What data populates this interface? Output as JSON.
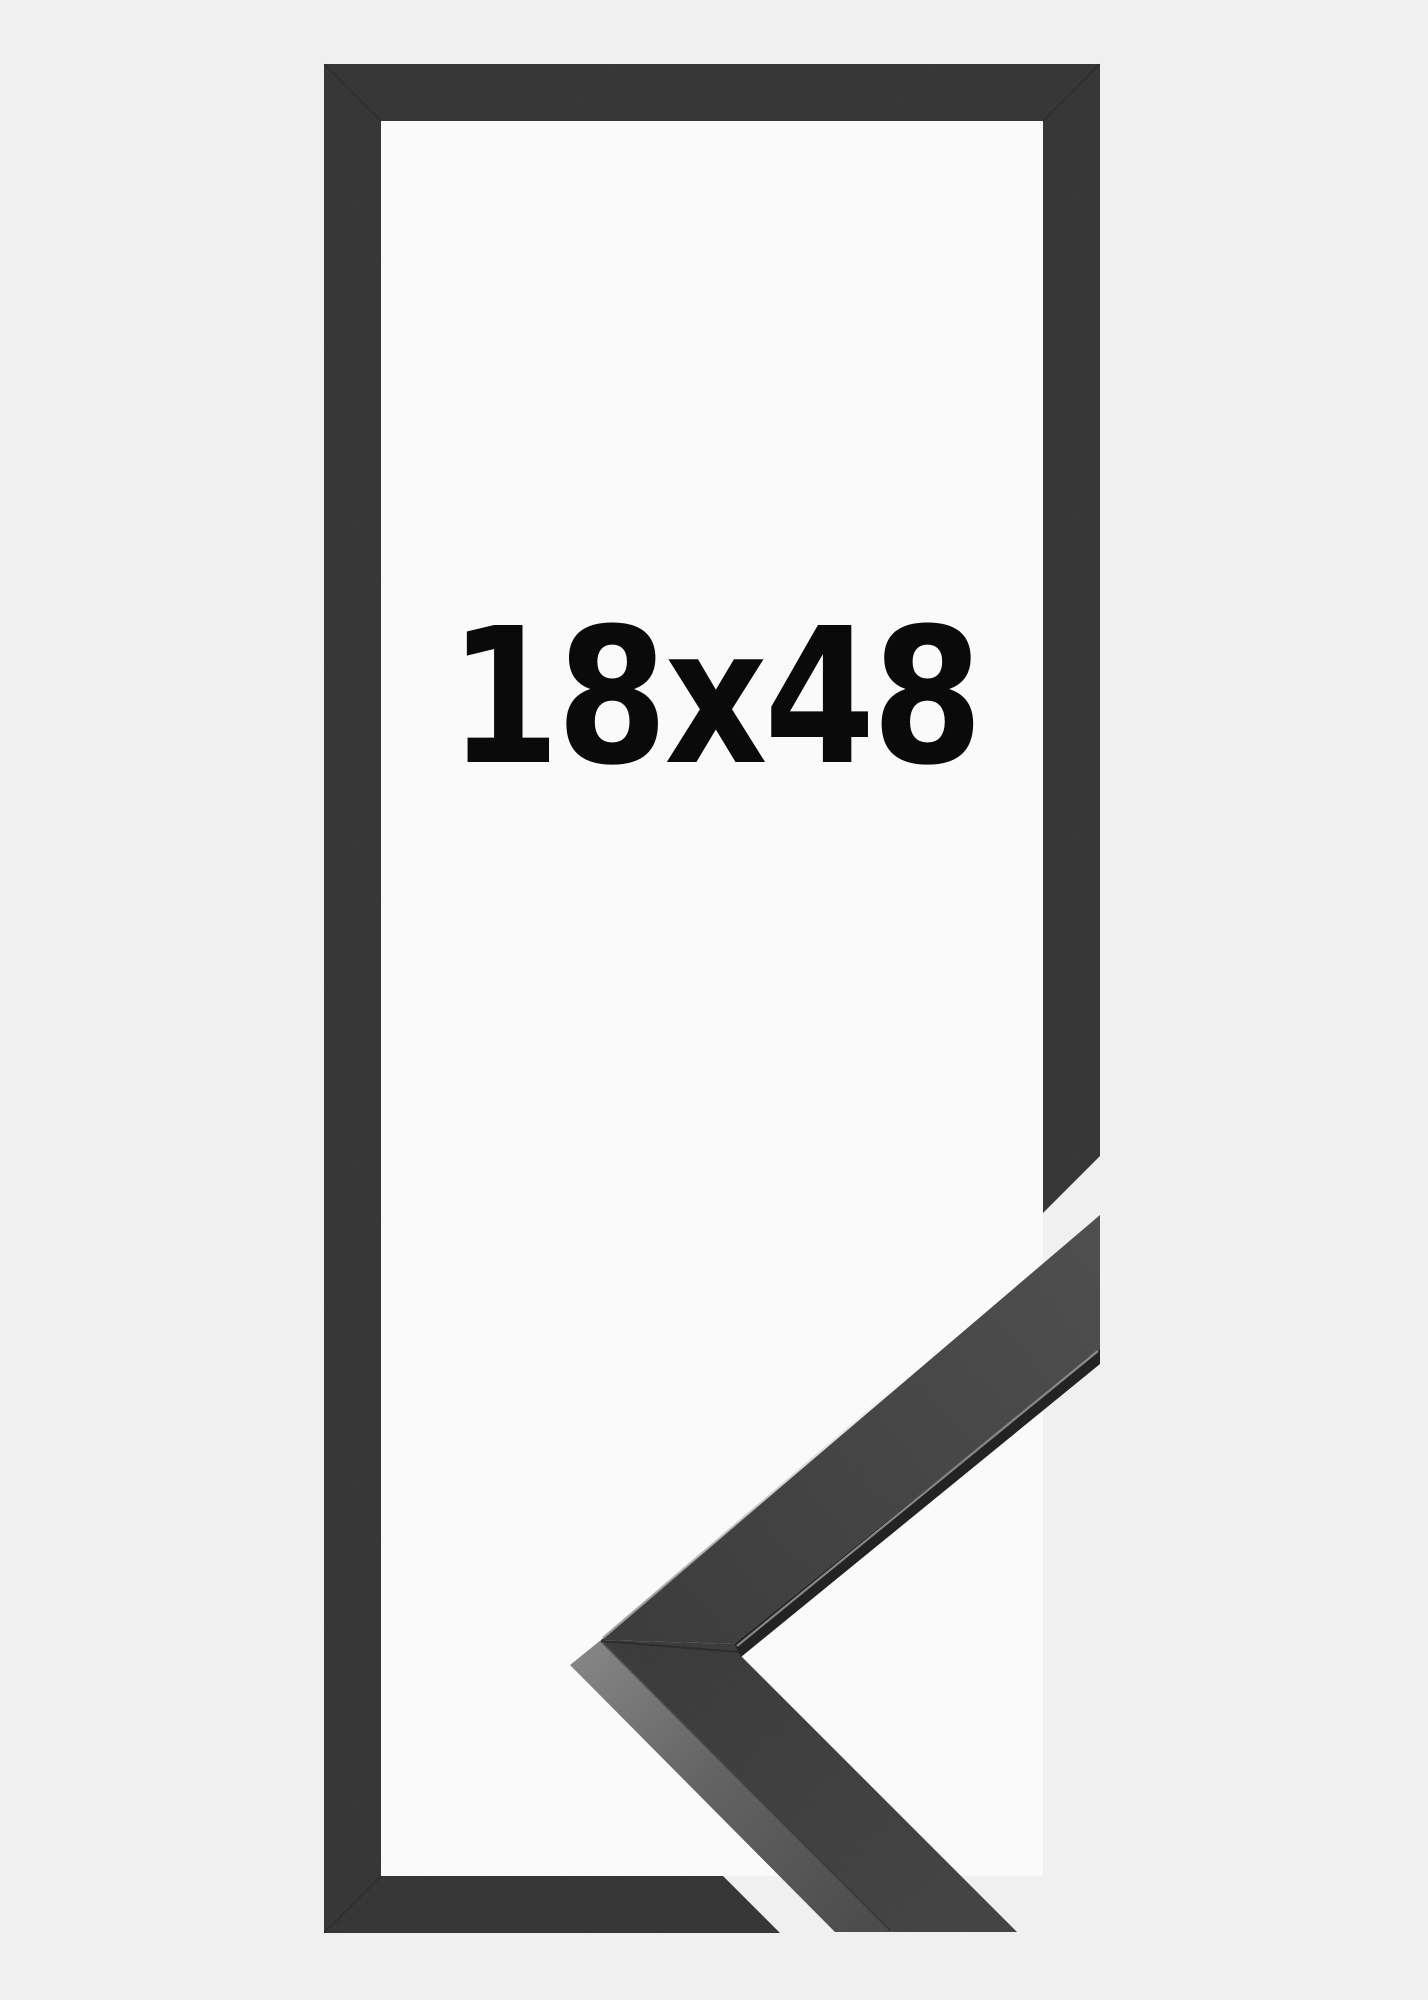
{
  "product": {
    "size_label": "18x48"
  },
  "illustration": {
    "subject": "black picture frame, portrait orientation, with mitered corner profile sample at lower right",
    "parts": [
      "frame-outline",
      "frame-corner-profile-sample",
      "size-label"
    ]
  },
  "colors": {
    "background_outer": "#f0f0f1",
    "background_inner": "#fafafa",
    "frame_bar": "#313131",
    "corner_face_dark": "#363636",
    "corner_face_light": "#4a4a4a",
    "corner_lower_face": "#3f3f3f",
    "corner_side_light": "#828282",
    "corner_side_mid": "#5f5f5f",
    "corner_side_dark": "#474747",
    "lip_shadow": "#232323",
    "lip_highlight": "#989898",
    "label_text": "#0a0a0a"
  }
}
